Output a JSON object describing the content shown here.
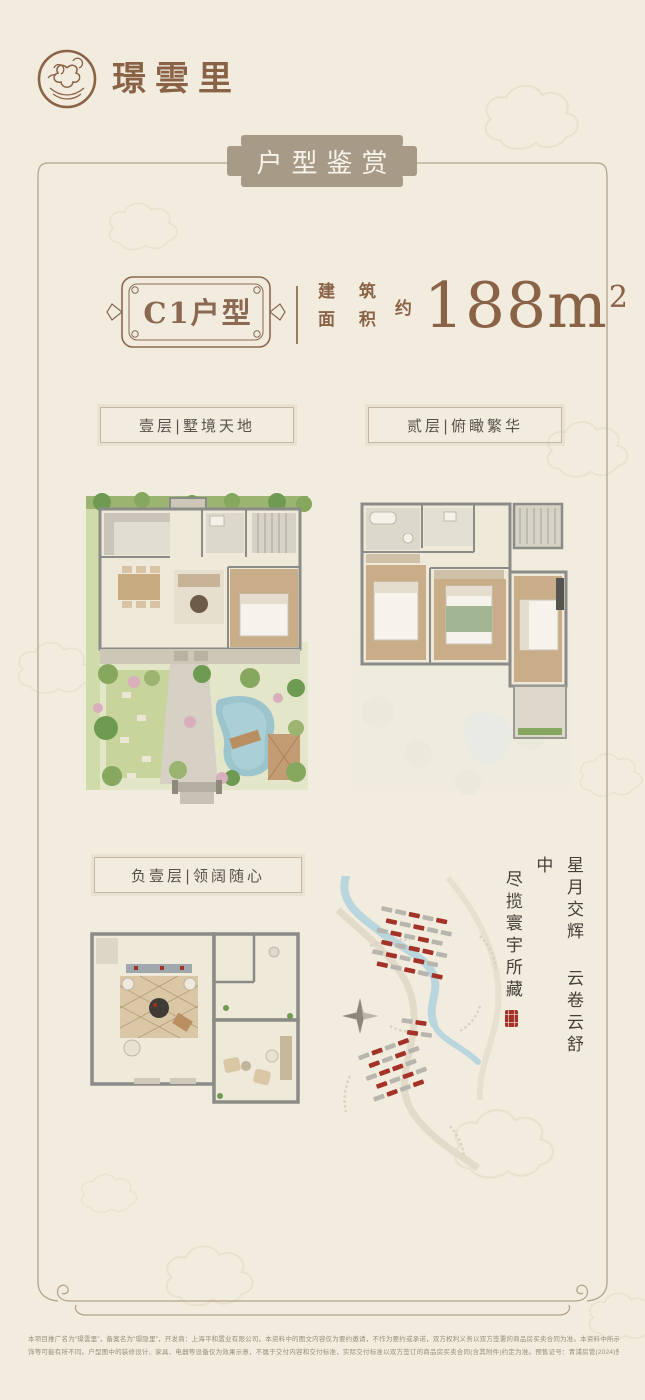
{
  "brand": {
    "name": "璟雲里"
  },
  "banner": {
    "title": "户型鉴赏"
  },
  "unit": {
    "name": "C1户型",
    "area_label": [
      "建 筑",
      "面 积"
    ],
    "area_approx": "约",
    "area_value": "188",
    "area_unit": "m",
    "area_exp": "2"
  },
  "floor_labels": {
    "first": "壹层|墅境天地",
    "second": "贰层|俯瞰繁华",
    "basement": "负壹层|领阔随心"
  },
  "poem": {
    "col1": "星月交辉 云卷云舒中",
    "col2": "尽揽寰宇所藏"
  },
  "disclaimer": {
    "line1": "本项目推广名为“璟雲里”，备案名为“璟隐里”，开发商：上海平和置业有限公司。本资料中的图文内容仅为要约邀请，不作为要约或承诺，双方权利义务以双方签署的商品房买卖合同为准。本资料中所示区域范围仅为示意图例，项目周边环境、户型信息仅供参考，墙体、绿化、单元、朝向等不同，局部结构、细部尺寸、涂料、装",
    "line2": "饰等可能有所不同。户型图中的装修设计、家具、电器等设备仅为效果示意，不属于交付内容和交付标准，实际交付标准以双方签订的商品房买卖合同(含其附件)约定为准。预售证号：青浦房管(2024)预字0000403号，本资料于2024年制作。"
  },
  "colors": {
    "background": "#f2ecdf",
    "brand_brown": "#8a6347",
    "plaque_taupe": "#a79b87",
    "frame_line": "#b3a48c",
    "accent_red": "#a23126",
    "river_blue": "#b9d6de",
    "lawn_green": "#c7d49c"
  }
}
